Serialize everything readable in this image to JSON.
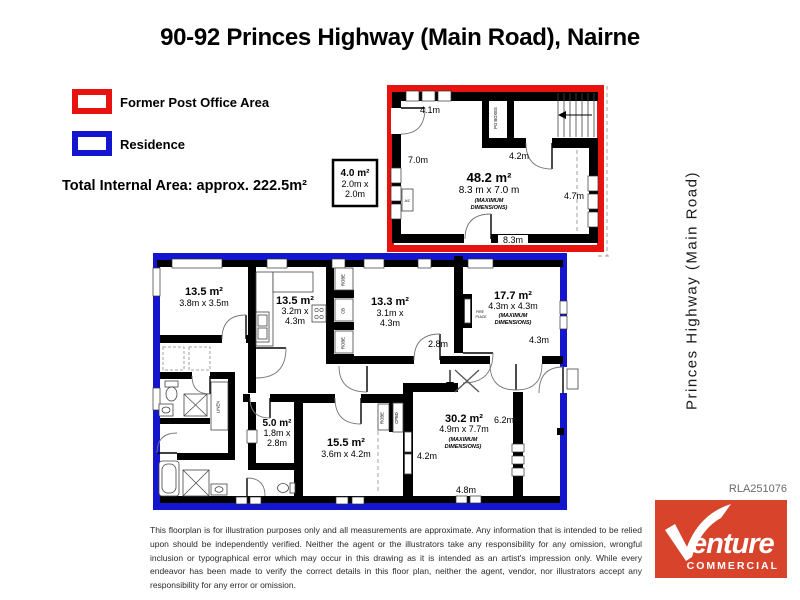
{
  "title": "90-92 Princes Highway (Main Road), Nairne",
  "legend": {
    "post_office": "Former Post Office Area",
    "residence": "Residence",
    "total_area": "Total Internal Area: approx. 222.5m²"
  },
  "street": "Princes Highway (Main Road)",
  "rla": "RLA251076",
  "logo": {
    "name_rest": "enture",
    "tagline": "COMMERCIAL"
  },
  "notes": {
    "max1": "(MAXIMUM",
    "max2": "DIMENSIONS)"
  },
  "annex": {
    "area": "4.0 m²",
    "dims1": "2.0m x",
    "dims2": "2.0m"
  },
  "post_office": {
    "area": "48.2 m²",
    "dims": "8.3 m x 7.0 m",
    "po_boxes": "PO BOXES",
    "ac": "A/C",
    "dims_top": "4.1m",
    "dims_left": "7.0m",
    "dims_mid": "4.2m",
    "dims_right": "4.7m",
    "dims_bottom": "8.3m"
  },
  "residence": {
    "bed1": {
      "area": "13.5 m²",
      "dims": "3.8m x 3.5m"
    },
    "kitchen": {
      "area": "13.5 m²",
      "dims1": "3.2m x",
      "dims2": "4.3m"
    },
    "bed2": {
      "area": "13.3 m²",
      "dims1": "3.1m x",
      "dims2": "4.3m"
    },
    "lounge": {
      "area": "17.7 m²",
      "dims": "4.3m x 4.3m"
    },
    "laundry": {
      "area": "5.0 m²",
      "dims1": "1.8m x",
      "dims2": "2.8m"
    },
    "bed3": {
      "area": "15.5 m²",
      "dims": "3.6m x 4.2m"
    },
    "living": {
      "area": "30.2 m²",
      "dims": "4.9m x 7.7m"
    },
    "dims": {
      "hall": "2.8m",
      "lounge": "4.3m",
      "living_right": "6.2m",
      "living_left": "4.2m",
      "living_bottom": "4.8m"
    },
    "labels": {
      "robe": "ROBE",
      "cb": "CB",
      "cpbd": "CPBD",
      "linen": "LINEN",
      "fire1": "FIRE",
      "fire2": "PLACE"
    }
  },
  "disclaimer": "This floorplan is for illustration purposes only and all measurements are approximate. Any information that is intended to be relied upon should be independently verified. Neither the agent or the illustrators take any responsibility for any omission, wrongful inclusion or typographical error which may occur in this drawing as it is intended as an artist's impression only. While every endeavor has been made to verify the correct details in this floor plan, neither the agent, vendor, nor illustrators accept any responsibility for any error or omission.",
  "colors": {
    "post_office_outline": "#e8120e",
    "residence_outline": "#1415cf",
    "logo_red": "#d7432b"
  }
}
